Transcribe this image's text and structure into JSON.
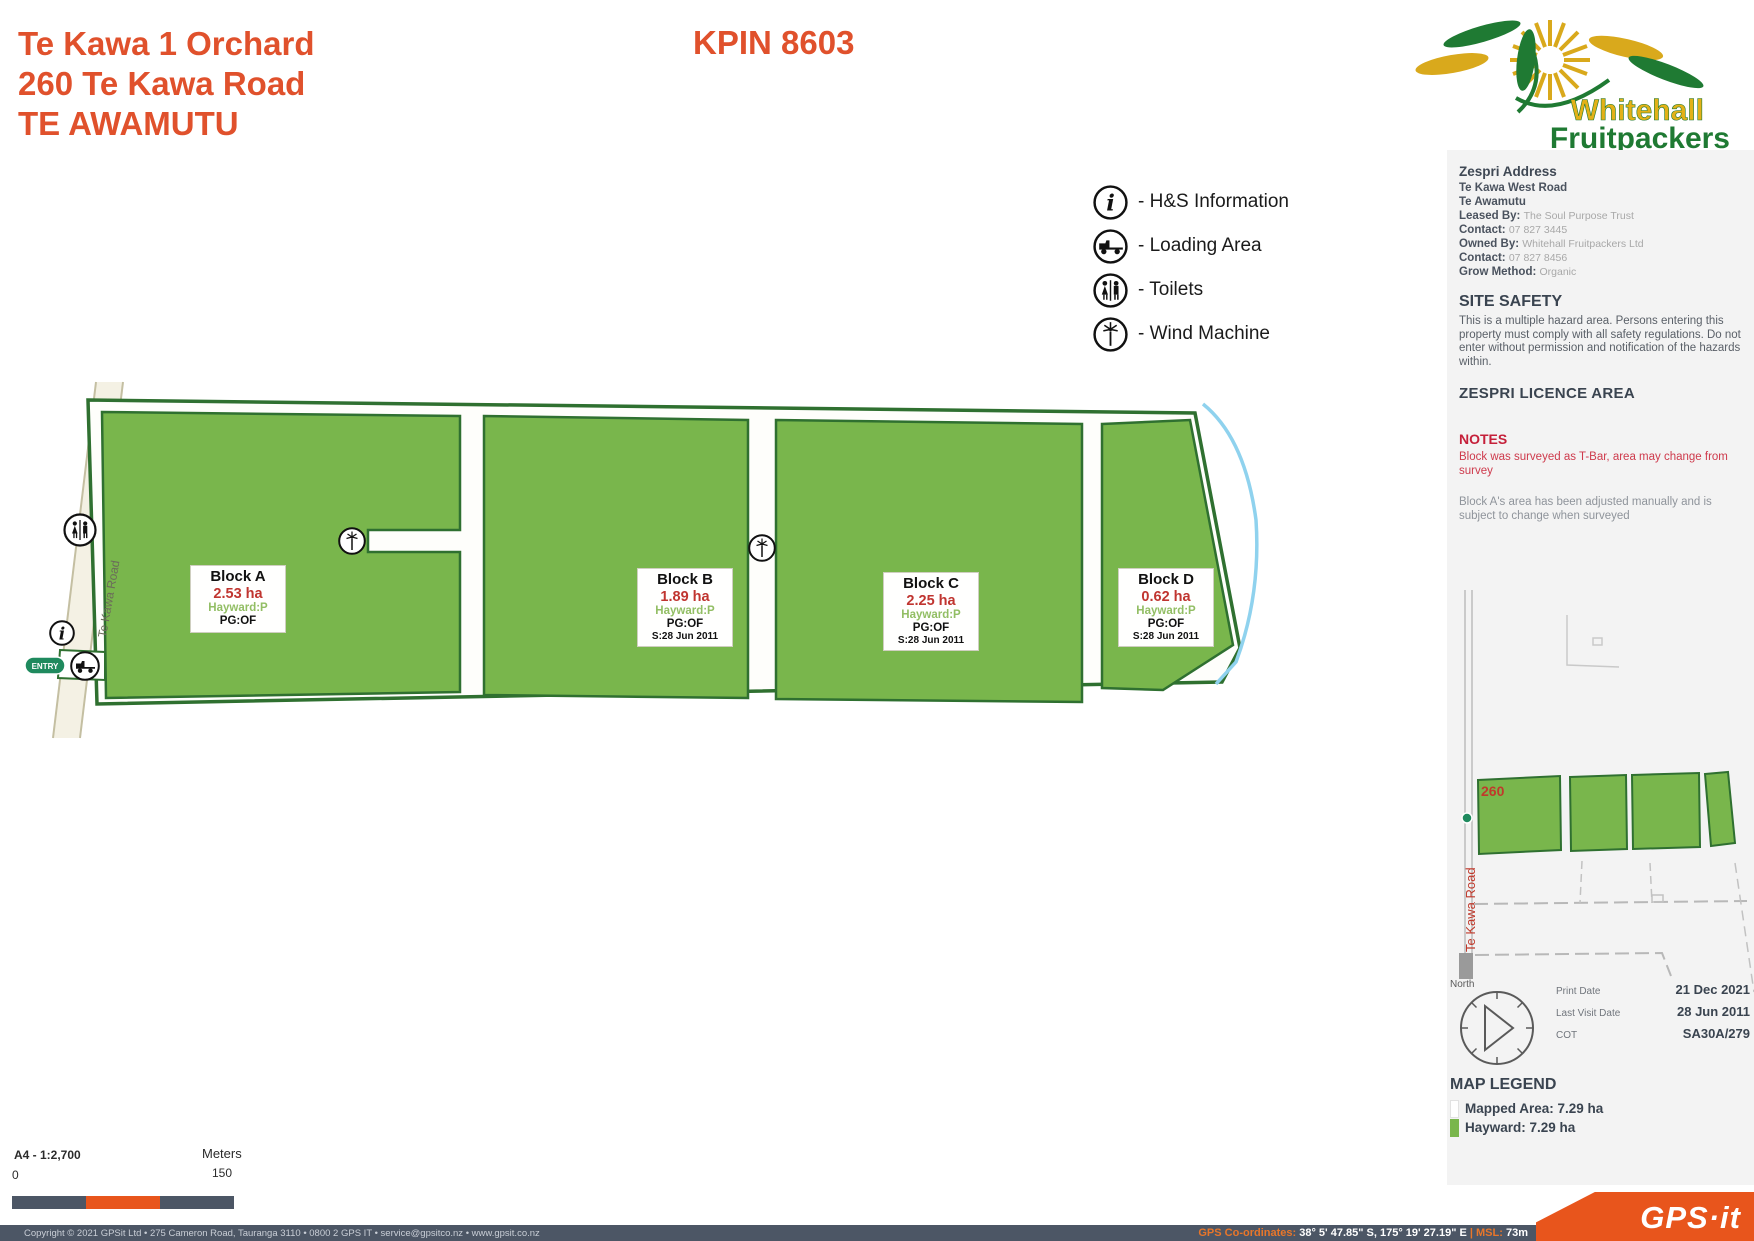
{
  "header": {
    "title_line1": "Te Kawa 1 Orchard",
    "title_line2": "260 Te Kawa Road",
    "title_line3": "TE AWAMUTU",
    "kpin": "KPIN 8603"
  },
  "logo": {
    "word1": "Whitehall",
    "word2": "Fruitpackers"
  },
  "legend": {
    "items": [
      {
        "icon": "info-icon",
        "label": "- H&S Information"
      },
      {
        "icon": "truck-icon",
        "label": "- Loading Area"
      },
      {
        "icon": "toilets-icon",
        "label": "- Toilets"
      },
      {
        "icon": "wind-machine-icon",
        "label": "- Wind Machine"
      }
    ]
  },
  "map": {
    "road_label": "Te Kawa Road",
    "entry_label": "ENTRY",
    "blocks": [
      {
        "name": "Block A",
        "area": "2.53 ha",
        "variety": "Hayward:P",
        "pg": "PG:OF",
        "surveyed": ""
      },
      {
        "name": "Block B",
        "area": "1.89 ha",
        "variety": "Hayward:P",
        "pg": "PG:OF",
        "surveyed": "S:28 Jun 2011"
      },
      {
        "name": "Block C",
        "area": "2.25 ha",
        "variety": "Hayward:P",
        "pg": "PG:OF",
        "surveyed": "S:28 Jun 2011"
      },
      {
        "name": "Block D",
        "area": "0.62 ha",
        "variety": "Hayward:P",
        "pg": "PG:OF",
        "surveyed": "S:28 Jun 2011"
      }
    ]
  },
  "sidebar": {
    "address_title": "Zespri Address",
    "address_line1": "Te Kawa West Road",
    "address_line2": "Te Awamutu",
    "rows": [
      {
        "k": "Leased By:",
        "v": "The Soul Purpose Trust"
      },
      {
        "k": "Contact:",
        "v": "07 827 3445"
      },
      {
        "k": "Owned By:",
        "v": "Whitehall Fruitpackers Ltd"
      },
      {
        "k": "Contact:",
        "v": "07 827 8456"
      },
      {
        "k": "Grow Method:",
        "v": "Organic"
      }
    ],
    "site_safety_title": "SITE SAFETY",
    "site_safety_text": "This is a multiple hazard area. Persons entering this property must comply with all safety regulations. Do not enter without permission and notification of the hazards within.",
    "licence_title": "ZESPRI LICENCE AREA",
    "notes_title": "NOTES",
    "note_red": "Block was surveyed as T-Bar, area may change from survey",
    "note_gray": "Block A's area has been adjusted manually and is subject to change when surveyed"
  },
  "minimap": {
    "number": "260",
    "road_label": "Te Kawa Road",
    "north_label": "North"
  },
  "info_rows": [
    {
      "label": "Print Date",
      "value": "21 Dec 2021"
    },
    {
      "label": "Last Visit Date",
      "value": "28 Jun 2011"
    },
    {
      "label": "COT",
      "value": "SA30A/279"
    }
  ],
  "map_legend": {
    "title": "MAP LEGEND",
    "row1": "Mapped Area: 7.29 ha",
    "row2": "Hayward: 7.29 ha",
    "hayward_color": "#79B64C"
  },
  "scale": {
    "format": "A4 - 1:2,700",
    "zero": "0",
    "unit": "Meters",
    "max": "150"
  },
  "footer": {
    "copyright": "Copyright © 2021 GPSit Ltd • 275 Cameron Road, Tauranga 3110 • 0800 2 GPS IT • service@gpsitco.nz • www.gpsit.co.nz",
    "gps_label": "GPS Co-ordinates:",
    "gps_value": "38° 5' 47.85\" S, 175° 19' 27.19\" E",
    "msl_label": "| MSL:",
    "msl_value": "73m",
    "brand": "GPS·it"
  },
  "colors": {
    "accent_orange": "#E0512C",
    "block_green": "#79B64C",
    "boundary_green": "#2F7030",
    "stream_blue": "#8FD2EE",
    "footer_slate": "#4C5665",
    "badge_orange": "#E8551C"
  }
}
